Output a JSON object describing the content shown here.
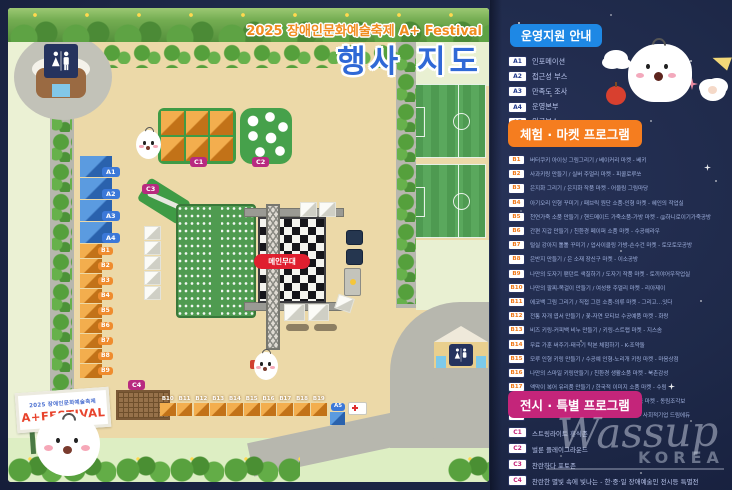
{
  "map": {
    "title_small": "2025 장애인문화예술축제 A+ Festival",
    "title_large": "행사 지도",
    "stage_label": "메인무대",
    "sign_line1": "2025 장애인문화예술축제",
    "sign_line2": "A+FESTIVAL",
    "booths": {
      "a_column": [
        "A1",
        "A2",
        "A3",
        "A4"
      ],
      "b_column": [
        "B1",
        "B2",
        "B3",
        "B4",
        "B5",
        "B6",
        "B7",
        "B8",
        "B9"
      ],
      "b_row": [
        "B10",
        "B11",
        "B12",
        "B13",
        "B14",
        "B15",
        "B16",
        "B17",
        "B18",
        "B19"
      ],
      "a5_label": "A5",
      "c_badges": [
        "C1",
        "C2",
        "C3",
        "C4"
      ]
    }
  },
  "legend": {
    "sections": [
      {
        "title": "운영지원 안내",
        "accent": "#1e88e5",
        "items": [
          {
            "code": "A1",
            "text": "인포메이션"
          },
          {
            "code": "A2",
            "text": "접근성 부스"
          },
          {
            "code": "A3",
            "text": "만족도 조사"
          },
          {
            "code": "A4",
            "text": "운영본부"
          },
          {
            "code": "A5",
            "text": "의료부스"
          }
        ]
      },
      {
        "title": "체험 · 마켓 프로그램",
        "accent": "#f57d1f",
        "items": [
          {
            "code": "B1",
            "text": "버터쿠키 아이싱 그림그리기 / 베이커리 마켓 - 베키"
          },
          {
            "code": "B2",
            "text": "사과키링 만들기 / 실버 주얼리 마켓 - 피콜로루쏘"
          },
          {
            "code": "B3",
            "text": "은지화 그리기 / 은지화 작품 마켓 - 어울림 그림마당"
          },
          {
            "code": "B4",
            "text": "아기오리 인형 꾸미기 / 패브릭 원단 소품-인형 마켓 - 혜인의 작업실"
          },
          {
            "code": "B5",
            "text": "천연가죽 소품 만들기 / 핸드메이드 가죽소품-가방 마켓 - @하니로이기가죽공방"
          },
          {
            "code": "B6",
            "text": "간편 지갑 만들기 / 친환경 페이퍼 소품 마켓 - 수공예라우"
          },
          {
            "code": "B7",
            "text": "털실 강아지 톨톨 꾸미기 / 업사이클링 가방-손수건 마켓 - 토모토모공방"
          },
          {
            "code": "B8",
            "text": "은반지 만들기 / 은 소재 장신구 마켓 - 이소공방"
          },
          {
            "code": "B9",
            "text": "나만의 도자기 팬던트 색칠하기 / 도자기 작품 마켓 - 토끼야어우작업실"
          },
          {
            "code": "B10",
            "text": "나만의 팔찌-목걸이 만들기 / 여성용 주얼리 마켓 - 리아제이"
          },
          {
            "code": "B11",
            "text": "에코백 그림 그리기 / 직접 그린 소품-의류 마켓 - 그리고…잇다"
          },
          {
            "code": "B12",
            "text": "전통 자개 엽서 만들기 / 꽃-자연 모티브 수공예품 마켓 - 화랑"
          },
          {
            "code": "B13",
            "text": "비즈 키링-커피백 비누 만들기 / 키링-스트랩 마켓 - 지스솜"
          },
          {
            "code": "B14",
            "text": "무료 가훈 써주기-태극기 탁본 체험하기 - K-조약돌"
          },
          {
            "code": "B15",
            "text": "모루 인형 키링 만들기 / 수공예 인형-노리개 키링 마켓 - 마음상점"
          },
          {
            "code": "B16",
            "text": "나만의 스마일 키링만들기 / 친환경 생활소품 마켓 - 북촌감성"
          },
          {
            "code": "B17",
            "text": "액막이 복어 유리품 만들기 / 한국적 이미지 소품 마켓 - 수림"
          },
          {
            "code": "B18",
            "text": "조각보액자-방석조각보 모빌 만들기 / 조각보 소품 마켓 - 동림조각보"
          },
          {
            "code": "B19",
            "text": "걱정인형 만들기,네일클로버, 스마일키링만들기 - 사회적기업 드림에듀"
          }
        ]
      },
      {
        "title": "전시 · 특별 프로그램",
        "accent": "#c4257a",
        "items": [
          {
            "code": "C1",
            "text": "스트링라이트 휴식존"
          },
          {
            "code": "C2",
            "text": "벌룬 플레이그라운드"
          },
          {
            "code": "C3",
            "text": "찬란하다 포토존"
          },
          {
            "code": "C4",
            "text": "찬란한 별빛 속에 빛나는 - 한·중·일 장애예술인 전시등 특별전"
          }
        ]
      }
    ]
  },
  "watermark": {
    "script": "Wassup",
    "sub": "KOREA"
  },
  "icons": {
    "sparkle": "4-point-star",
    "restroom": "man-woman-figures"
  }
}
